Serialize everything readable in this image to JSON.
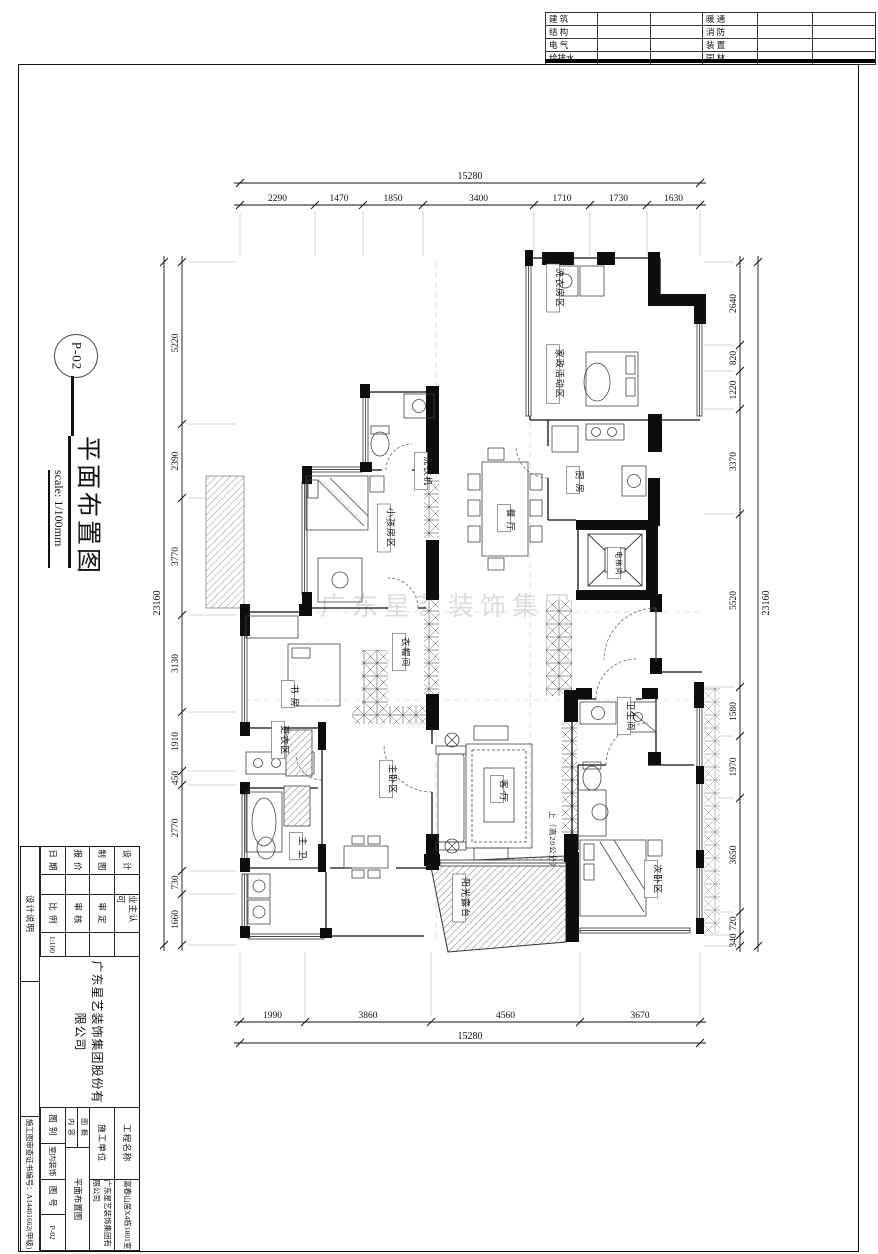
{
  "top_table": {
    "left": [
      "建 筑",
      "结 构",
      "电 气",
      "给排水"
    ],
    "right": [
      "暖 通",
      "消 防",
      "装 置",
      "园 林"
    ]
  },
  "drawing_label": {
    "number": "P-02",
    "title": "平面布置图",
    "scale_note": "scale: 1/100mm"
  },
  "dimensions": {
    "top": {
      "total": "15280",
      "segments": [
        "2290",
        "1470",
        "1850",
        "3400",
        "1710",
        "1730",
        "1630"
      ]
    },
    "bottom": {
      "total": "15280",
      "segments": [
        "1990",
        "3860",
        "4560",
        "3670"
      ]
    },
    "left": {
      "total": "23160",
      "segments": [
        "5220",
        "2390",
        "3770",
        "3130",
        "1910",
        "450",
        "2770",
        "730",
        "1660"
      ]
    },
    "right": {
      "total": "23160",
      "segments": [
        "2640",
        "820",
        "1220",
        "3370",
        "5520",
        "1580",
        "1970",
        "3650",
        "720",
        "340"
      ]
    }
  },
  "rooms": [
    {
      "label": "洗衣房区"
    },
    {
      "label": "家政活动区"
    },
    {
      "label": "厨 房"
    },
    {
      "label": "电梯间"
    },
    {
      "label": "餐 厅"
    },
    {
      "label": "小孩房区"
    },
    {
      "label": "洗衣机"
    },
    {
      "label": "书 房"
    },
    {
      "label": "衣帽间"
    },
    {
      "label": "更衣区"
    },
    {
      "label": "主 卫"
    },
    {
      "label": "主卧区"
    },
    {
      "label": "客 厅"
    },
    {
      "label": "阳光露台"
    },
    {
      "label": "卫生间"
    },
    {
      "label": "次卧区"
    },
    {
      "label": "上（高20公分）"
    }
  ],
  "title_block": {
    "company": "广东星艺装饰集团股份有限公司",
    "rows_a": [
      "设 计",
      "制 图",
      "报 价",
      "日 期"
    ],
    "rows_b_labels": [
      "业主认可",
      "审 定",
      "审 核",
      "比 例"
    ],
    "rows_b_values": [
      "",
      "",
      "",
      "1:100"
    ],
    "project_label": "工程名称",
    "project_value": "富春山居X4栋1801室",
    "builder_label": "施工单位",
    "builder_value": "广东星艺装饰集团有限公司",
    "content_label_1": "图 概",
    "content_label_2": "内 容",
    "content_value": "平面布置图",
    "category_label": "图 别",
    "category_value": "室内装饰",
    "number_label": "图 号",
    "number_value": "P-02",
    "notes_strip": "设计说明",
    "cert": "施工图审查证书编号：A14401662(甲级)"
  },
  "watermark": "广东星艺装饰集团"
}
